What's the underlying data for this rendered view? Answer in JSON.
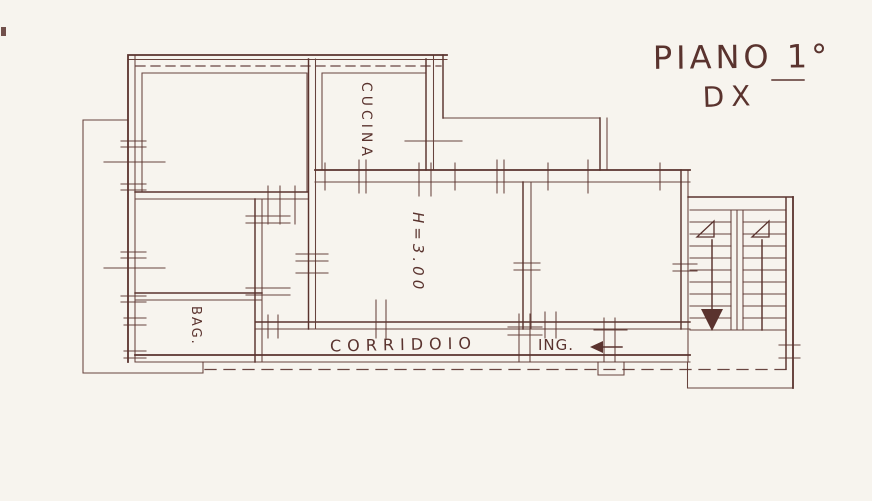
{
  "canvas": {
    "width": 872,
    "height": 501
  },
  "colors": {
    "paper": "#f7f4ee",
    "ink": "#5a332e"
  },
  "header": {
    "floor": "PIANO 1°",
    "unit": "DX"
  },
  "labels": {
    "kitchen": "CUCINA",
    "bathroom": "BAG.",
    "corridor": "CORRIDOIO",
    "entrance": "ING.",
    "ceiling_height": "H=3.00"
  }
}
